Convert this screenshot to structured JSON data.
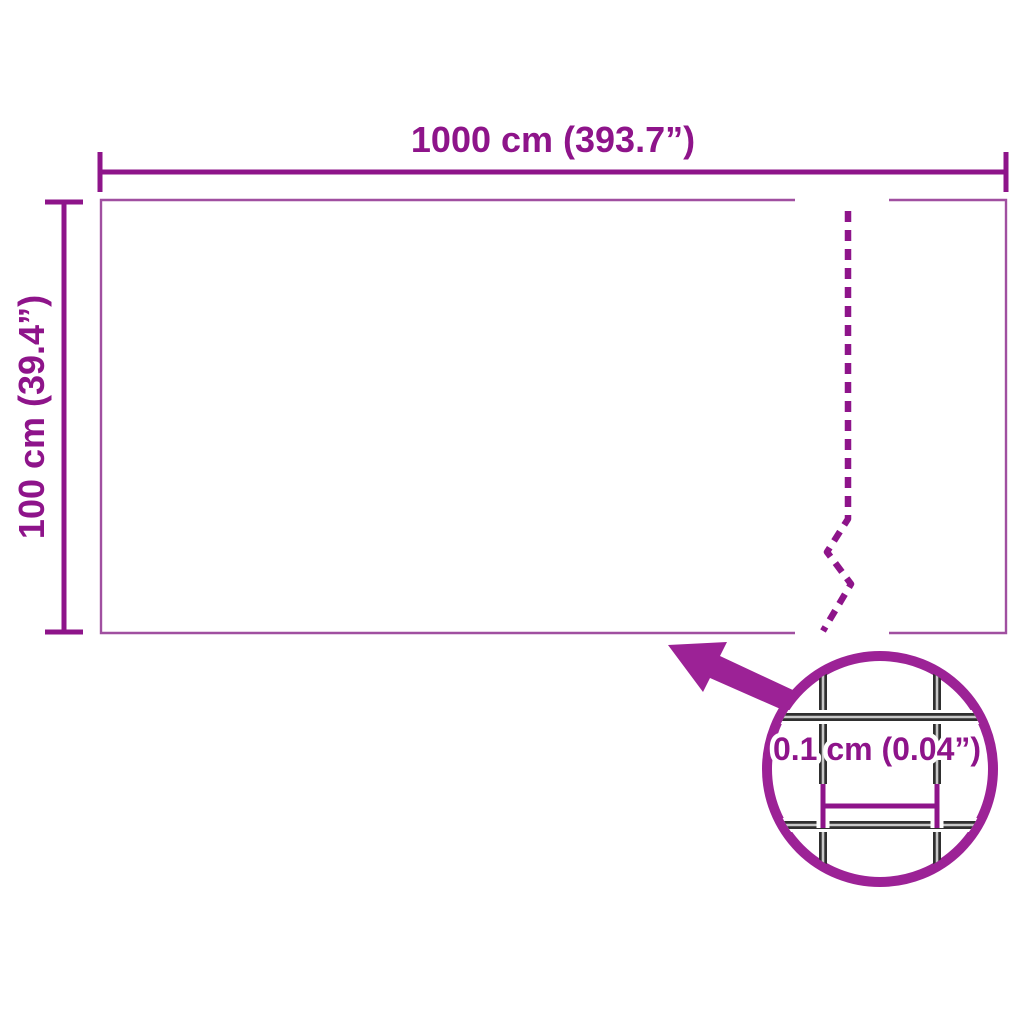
{
  "colors": {
    "purple_dark": "#8E148A",
    "purple_bright": "#9C2296",
    "purple_outline": "#A04FA0",
    "wire_dark": "#2F2F2F",
    "wire_highlight": "#C8C8C8",
    "background": "#FFFFFF"
  },
  "diagram": {
    "type": "product-dimension-diagram",
    "width_dimension": {
      "label": "1000 cm (393.7”)"
    },
    "height_dimension": {
      "label": "100 cm (39.4”)"
    },
    "detail": {
      "label": "0.1 cm (0.04”)"
    }
  }
}
